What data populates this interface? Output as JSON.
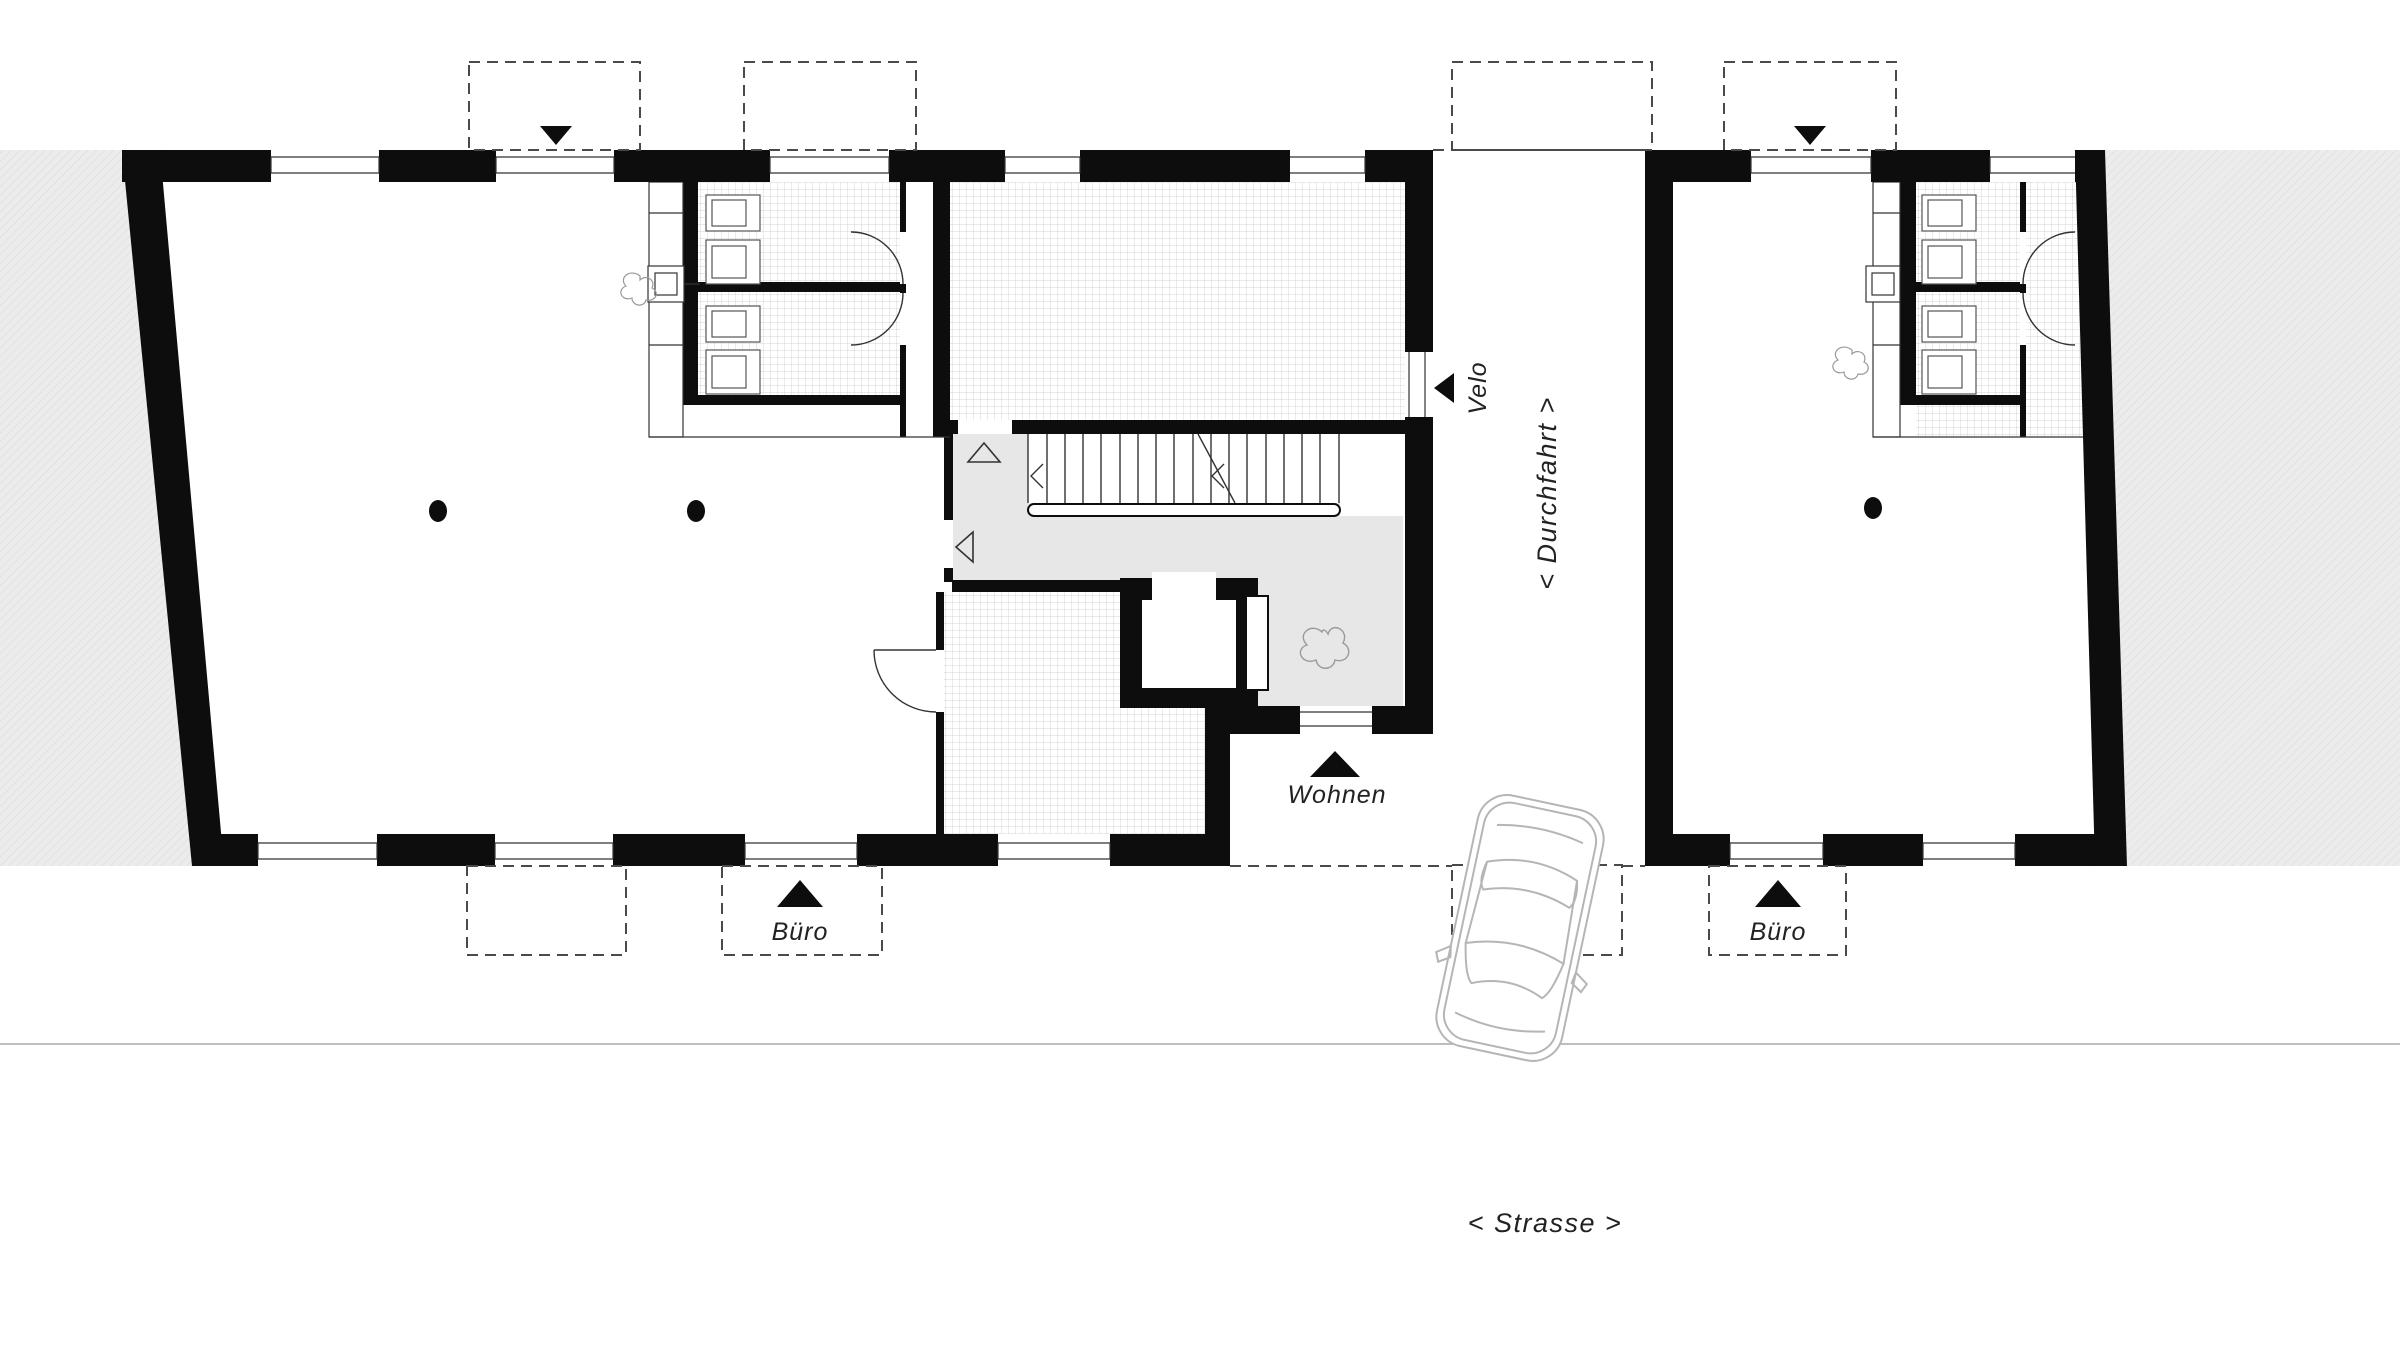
{
  "drawing": {
    "kind_note": "black-and-white architectural ground floor plan, two buildings with a passage between them",
    "labels": {
      "velo": "Velo",
      "durchfahrt": "< Durchfahrt >",
      "wohnen": "Wohnen",
      "buero_left": "Büro",
      "buero_right": "Büro",
      "strasse": "< Strasse >"
    },
    "markers": {
      "top_left_entrance_icon": "triangle-down",
      "top_right_entrance_icon": "triangle-down",
      "velo_arrow_icon": "triangle-left",
      "wohnen_arrow_icon": "triangle-up",
      "buero_left_arrow_icon": "triangle-up",
      "buero_right_arrow_icon": "triangle-up",
      "stair_direction_icons": "open triangle up, open triangle left, chevrons on stair run",
      "car_icon": "car top view parked in Durchfahrt"
    },
    "colors": {
      "wall": "#0d0d0d",
      "site_band": "#ececec",
      "hall_floor": "#e7e7e7",
      "tile_line": "#c6c6c6",
      "hatch_line": "#dcdcdc",
      "dash_line": "#4a4a4a",
      "thin_line": "#333333",
      "car_line": "#b5b5b5",
      "street_line": "#a8a8a8",
      "text": "#222222"
    },
    "counts": {
      "columns_left_building": 2,
      "columns_right_building": 1,
      "wc_rooms_per_building": 2
    }
  }
}
